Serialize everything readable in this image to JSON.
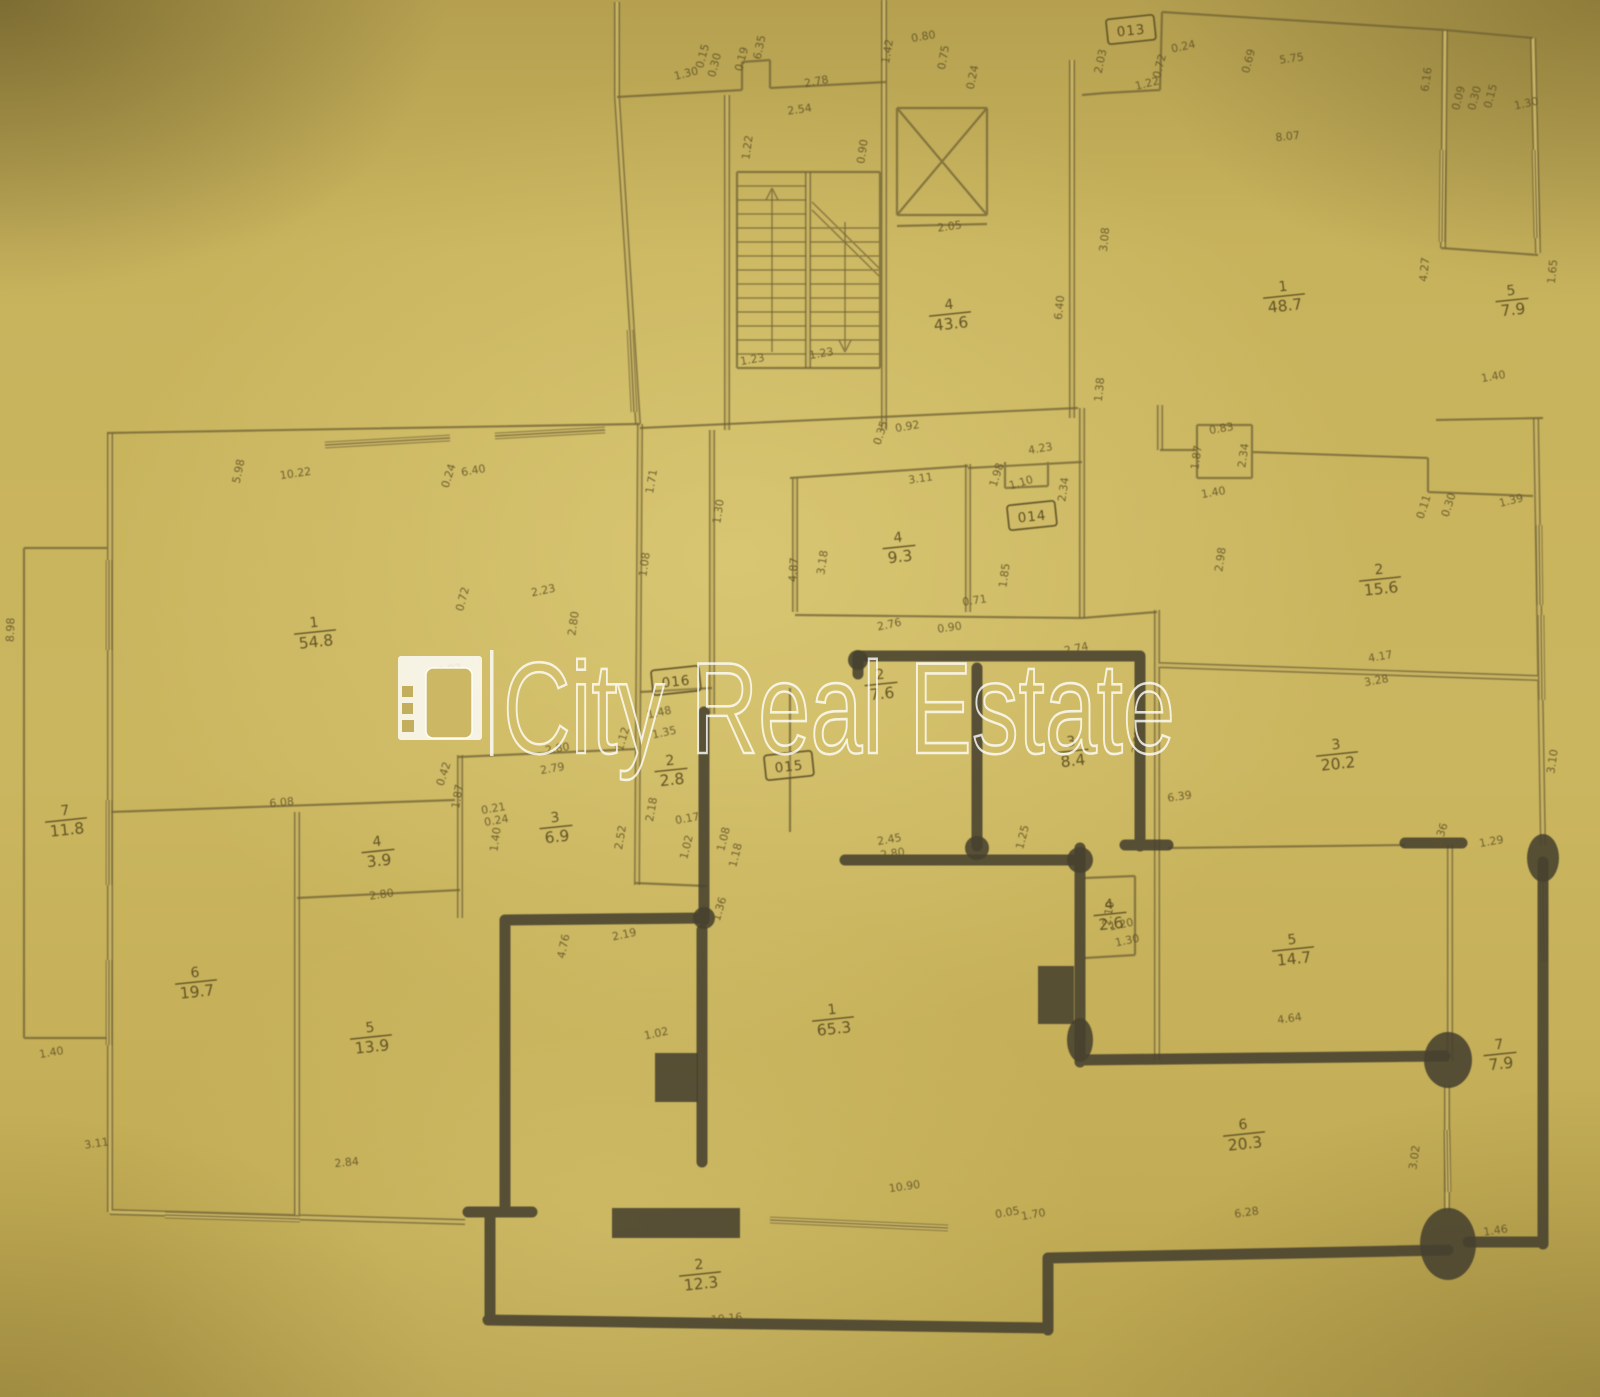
{
  "watermark": {
    "text": "City Real Estate",
    "color": "#ffffff"
  },
  "plan": {
    "paper_color": "#cbb660",
    "line_color": "#6f6134",
    "marker_color": "#47412f",
    "door_tags": [
      {
        "label": "013",
        "x": 1131,
        "y": 30
      },
      {
        "label": "014",
        "x": 1032,
        "y": 516
      },
      {
        "label": "016",
        "x": 676,
        "y": 681
      },
      {
        "label": "015",
        "x": 789,
        "y": 766
      }
    ],
    "rooms": [
      {
        "number": "1",
        "area": "54.8",
        "x": 315,
        "y": 632
      },
      {
        "number": "4",
        "area": "43.6",
        "x": 950,
        "y": 314
      },
      {
        "number": "1",
        "area": "48.7",
        "x": 1284,
        "y": 296
      },
      {
        "number": "5",
        "area": "7.9",
        "x": 1512,
        "y": 300
      },
      {
        "number": "4",
        "area": "9.3",
        "x": 899,
        "y": 547
      },
      {
        "number": "2",
        "area": "15.6",
        "x": 1380,
        "y": 579
      },
      {
        "number": "3",
        "area": "20.2",
        "x": 1337,
        "y": 754
      },
      {
        "number": "3",
        "area": "8.4",
        "x": 1072,
        "y": 751
      },
      {
        "number": "2",
        "area": "7.6",
        "x": 881,
        "y": 684
      },
      {
        "number": "2",
        "area": "2.8",
        "x": 671,
        "y": 770
      },
      {
        "number": "3",
        "area": "6.9",
        "x": 556,
        "y": 827
      },
      {
        "number": "4",
        "area": "3.9",
        "x": 378,
        "y": 851
      },
      {
        "number": "7",
        "area": "11.8",
        "x": 66,
        "y": 820
      },
      {
        "number": "6",
        "area": "19.7",
        "x": 196,
        "y": 982
      },
      {
        "number": "5",
        "area": "13.9",
        "x": 371,
        "y": 1037
      },
      {
        "number": "1",
        "area": "65.3",
        "x": 833,
        "y": 1019
      },
      {
        "number": "4",
        "area": "2.6",
        "x": 1110,
        "y": 914
      },
      {
        "number": "5",
        "area": "14.7",
        "x": 1293,
        "y": 949
      },
      {
        "number": "7",
        "area": "7.9",
        "x": 1500,
        "y": 1054
      },
      {
        "number": "6",
        "area": "20.3",
        "x": 1244,
        "y": 1134
      },
      {
        "number": "2",
        "area": "12.3",
        "x": 700,
        "y": 1274
      }
    ],
    "dimensions": [
      {
        "t": "1.30",
        "x": 687,
        "y": 77,
        "r": -14
      },
      {
        "t": "0.15",
        "x": 706,
        "y": 57,
        "r": -75
      },
      {
        "t": "0.30",
        "x": 718,
        "y": 66,
        "r": -75
      },
      {
        "t": "0.19",
        "x": 745,
        "y": 60,
        "r": -75
      },
      {
        "t": "6.35",
        "x": 763,
        "y": 48,
        "r": -78
      },
      {
        "t": "2.78",
        "x": 817,
        "y": 85,
        "r": -10
      },
      {
        "t": "2.54",
        "x": 800,
        "y": 113,
        "r": -8
      },
      {
        "t": "1.22",
        "x": 751,
        "y": 148,
        "r": -82
      },
      {
        "t": "0.90",
        "x": 866,
        "y": 152,
        "r": -82
      },
      {
        "t": "1.42",
        "x": 891,
        "y": 52,
        "r": -80
      },
      {
        "t": "0.80",
        "x": 924,
        "y": 40,
        "r": -10
      },
      {
        "t": "0.75",
        "x": 947,
        "y": 58,
        "r": -80
      },
      {
        "t": "0.24",
        "x": 976,
        "y": 78,
        "r": -78
      },
      {
        "t": "2.03",
        "x": 1104,
        "y": 62,
        "r": -78
      },
      {
        "t": "1.22",
        "x": 1148,
        "y": 87,
        "r": -14
      },
      {
        "t": "0.24",
        "x": 1184,
        "y": 50,
        "r": -12
      },
      {
        "t": "0.72",
        "x": 1163,
        "y": 67,
        "r": -75
      },
      {
        "t": "0.69",
        "x": 1252,
        "y": 62,
        "r": -75
      },
      {
        "t": "5.75",
        "x": 1292,
        "y": 62,
        "r": -8
      },
      {
        "t": "6.16",
        "x": 1430,
        "y": 80,
        "r": -82
      },
      {
        "t": "0.09",
        "x": 1462,
        "y": 99,
        "r": -75
      },
      {
        "t": "0.30",
        "x": 1478,
        "y": 99,
        "r": -75
      },
      {
        "t": "0.15",
        "x": 1494,
        "y": 97,
        "r": -75
      },
      {
        "t": "1.30",
        "x": 1527,
        "y": 107,
        "r": -12
      },
      {
        "t": "8.07",
        "x": 1288,
        "y": 140,
        "r": -6
      },
      {
        "t": "2.05",
        "x": 950,
        "y": 230,
        "r": -8
      },
      {
        "t": "1.23",
        "x": 753,
        "y": 363,
        "r": -10
      },
      {
        "t": "1.23",
        "x": 822,
        "y": 357,
        "r": -10
      },
      {
        "t": "6.40",
        "x": 1063,
        "y": 308,
        "r": -84
      },
      {
        "t": "1.38",
        "x": 1103,
        "y": 390,
        "r": -84
      },
      {
        "t": "4.23",
        "x": 1041,
        "y": 452,
        "r": -10
      },
      {
        "t": "3.08",
        "x": 1108,
        "y": 240,
        "r": -84
      },
      {
        "t": "4.27",
        "x": 1428,
        "y": 270,
        "r": -84
      },
      {
        "t": "1.65",
        "x": 1556,
        "y": 272,
        "r": -84
      },
      {
        "t": "1.40",
        "x": 1494,
        "y": 380,
        "r": -10
      },
      {
        "t": "5.98",
        "x": 242,
        "y": 472,
        "r": -78
      },
      {
        "t": "10.22",
        "x": 296,
        "y": 477,
        "r": -8
      },
      {
        "t": "0.24",
        "x": 452,
        "y": 477,
        "r": -72
      },
      {
        "t": "6.40",
        "x": 474,
        "y": 474,
        "r": -10
      },
      {
        "t": "1.71",
        "x": 655,
        "y": 482,
        "r": -80
      },
      {
        "t": "1.30",
        "x": 722,
        "y": 512,
        "r": -82
      },
      {
        "t": "1.08",
        "x": 648,
        "y": 565,
        "r": -82
      },
      {
        "t": "0.72",
        "x": 466,
        "y": 600,
        "r": -75
      },
      {
        "t": "2.23",
        "x": 544,
        "y": 594,
        "r": -12
      },
      {
        "t": "2.80",
        "x": 577,
        "y": 624,
        "r": -82
      },
      {
        "t": "0.92",
        "x": 450,
        "y": 673,
        "r": -10
      },
      {
        "t": "3.11",
        "x": 921,
        "y": 482,
        "r": -8
      },
      {
        "t": "1.98",
        "x": 1000,
        "y": 476,
        "r": -72
      },
      {
        "t": "1.10",
        "x": 1022,
        "y": 486,
        "r": -16
      },
      {
        "t": "2.34",
        "x": 1067,
        "y": 490,
        "r": -82
      },
      {
        "t": "4.87",
        "x": 797,
        "y": 570,
        "r": -86
      },
      {
        "t": "3.18",
        "x": 826,
        "y": 563,
        "r": -82
      },
      {
        "t": "0.71",
        "x": 975,
        "y": 604,
        "r": -8
      },
      {
        "t": "1.85",
        "x": 1008,
        "y": 576,
        "r": -82
      },
      {
        "t": "0.90",
        "x": 950,
        "y": 631,
        "r": -8
      },
      {
        "t": "0.92",
        "x": 908,
        "y": 430,
        "r": -10
      },
      {
        "t": "0.35",
        "x": 884,
        "y": 434,
        "r": -72
      },
      {
        "t": "0.83",
        "x": 1222,
        "y": 432,
        "r": -10
      },
      {
        "t": "1.87",
        "x": 1200,
        "y": 458,
        "r": -82
      },
      {
        "t": "2.34",
        "x": 1247,
        "y": 456,
        "r": -82
      },
      {
        "t": "1.40",
        "x": 1214,
        "y": 496,
        "r": -10
      },
      {
        "t": "0.11",
        "x": 1427,
        "y": 508,
        "r": -72
      },
      {
        "t": "0.30",
        "x": 1452,
        "y": 506,
        "r": -72
      },
      {
        "t": "1.39",
        "x": 1512,
        "y": 504,
        "r": -14
      },
      {
        "t": "2.98",
        "x": 1224,
        "y": 560,
        "r": -82
      },
      {
        "t": "2.74",
        "x": 1077,
        "y": 652,
        "r": -12
      },
      {
        "t": "2.76",
        "x": 890,
        "y": 628,
        "r": -12
      },
      {
        "t": "3.02",
        "x": 1141,
        "y": 742,
        "r": -82
      },
      {
        "t": "6.39",
        "x": 1180,
        "y": 800,
        "r": -8
      },
      {
        "t": "4.17",
        "x": 1381,
        "y": 660,
        "r": -10
      },
      {
        "t": "3.28",
        "x": 1377,
        "y": 684,
        "r": -10
      },
      {
        "t": "3.10",
        "x": 1556,
        "y": 762,
        "r": -82
      },
      {
        "t": "1.48",
        "x": 660,
        "y": 716,
        "r": -12
      },
      {
        "t": "1.12",
        "x": 626,
        "y": 740,
        "r": -74
      },
      {
        "t": "1.35",
        "x": 665,
        "y": 736,
        "r": -12
      },
      {
        "t": "2.80",
        "x": 558,
        "y": 752,
        "r": -10
      },
      {
        "t": "2.79",
        "x": 553,
        "y": 772,
        "r": -10
      },
      {
        "t": "2.18",
        "x": 655,
        "y": 810,
        "r": -80
      },
      {
        "t": "2.52",
        "x": 624,
        "y": 838,
        "r": -80
      },
      {
        "t": "0.17",
        "x": 688,
        "y": 822,
        "r": -10
      },
      {
        "t": "1.02",
        "x": 690,
        "y": 848,
        "r": -76
      },
      {
        "t": "1.08",
        "x": 727,
        "y": 840,
        "r": -76
      },
      {
        "t": "1.18",
        "x": 739,
        "y": 856,
        "r": -76
      },
      {
        "t": "2.45",
        "x": 890,
        "y": 843,
        "r": -10
      },
      {
        "t": "2.80",
        "x": 893,
        "y": 857,
        "r": -8
      },
      {
        "t": "1.25",
        "x": 1026,
        "y": 838,
        "r": -76
      },
      {
        "t": "2.19",
        "x": 625,
        "y": 938,
        "r": -12
      },
      {
        "t": "1.36",
        "x": 723,
        "y": 910,
        "r": -74
      },
      {
        "t": "4.76",
        "x": 567,
        "y": 947,
        "r": -78
      },
      {
        "t": "1.02",
        "x": 657,
        "y": 1037,
        "r": -12
      },
      {
        "t": "2.80",
        "x": 382,
        "y": 898,
        "r": -8
      },
      {
        "t": "6.08",
        "x": 282,
        "y": 806,
        "r": -5
      },
      {
        "t": "0.42",
        "x": 447,
        "y": 775,
        "r": -72
      },
      {
        "t": "1.87",
        "x": 461,
        "y": 797,
        "r": -80
      },
      {
        "t": "0.21",
        "x": 494,
        "y": 812,
        "r": -10
      },
      {
        "t": "0.24",
        "x": 497,
        "y": 824,
        "r": -10
      },
      {
        "t": "1.40",
        "x": 499,
        "y": 840,
        "r": -82
      },
      {
        "t": "1.40",
        "x": 52,
        "y": 1056,
        "r": -10
      },
      {
        "t": "3.11",
        "x": 97,
        "y": 1147,
        "r": -8
      },
      {
        "t": "2.84",
        "x": 347,
        "y": 1166,
        "r": -6
      },
      {
        "t": "8.98",
        "x": 14,
        "y": 630,
        "r": -88
      },
      {
        "t": "1.20",
        "x": 1122,
        "y": 928,
        "r": -12
      },
      {
        "t": "1.30",
        "x": 1128,
        "y": 944,
        "r": -12
      },
      {
        "t": "2.10",
        "x": 1112,
        "y": 914,
        "r": -80
      },
      {
        "t": "4.64",
        "x": 1290,
        "y": 1022,
        "r": -8
      },
      {
        "t": "10.90",
        "x": 905,
        "y": 1190,
        "r": -8
      },
      {
        "t": "0.05",
        "x": 1008,
        "y": 1216,
        "r": -10
      },
      {
        "t": "1.70",
        "x": 1034,
        "y": 1218,
        "r": -10
      },
      {
        "t": "6.28",
        "x": 1247,
        "y": 1216,
        "r": -8
      },
      {
        "t": "1.46",
        "x": 1496,
        "y": 1234,
        "r": -8
      },
      {
        "t": "3.02",
        "x": 1418,
        "y": 1158,
        "r": -82
      },
      {
        "t": "1.29",
        "x": 1492,
        "y": 845,
        "r": -10
      },
      {
        "t": "0.36",
        "x": 1444,
        "y": 836,
        "r": -72
      },
      {
        "t": "10.16",
        "x": 727,
        "y": 1322,
        "r": -6
      }
    ]
  }
}
